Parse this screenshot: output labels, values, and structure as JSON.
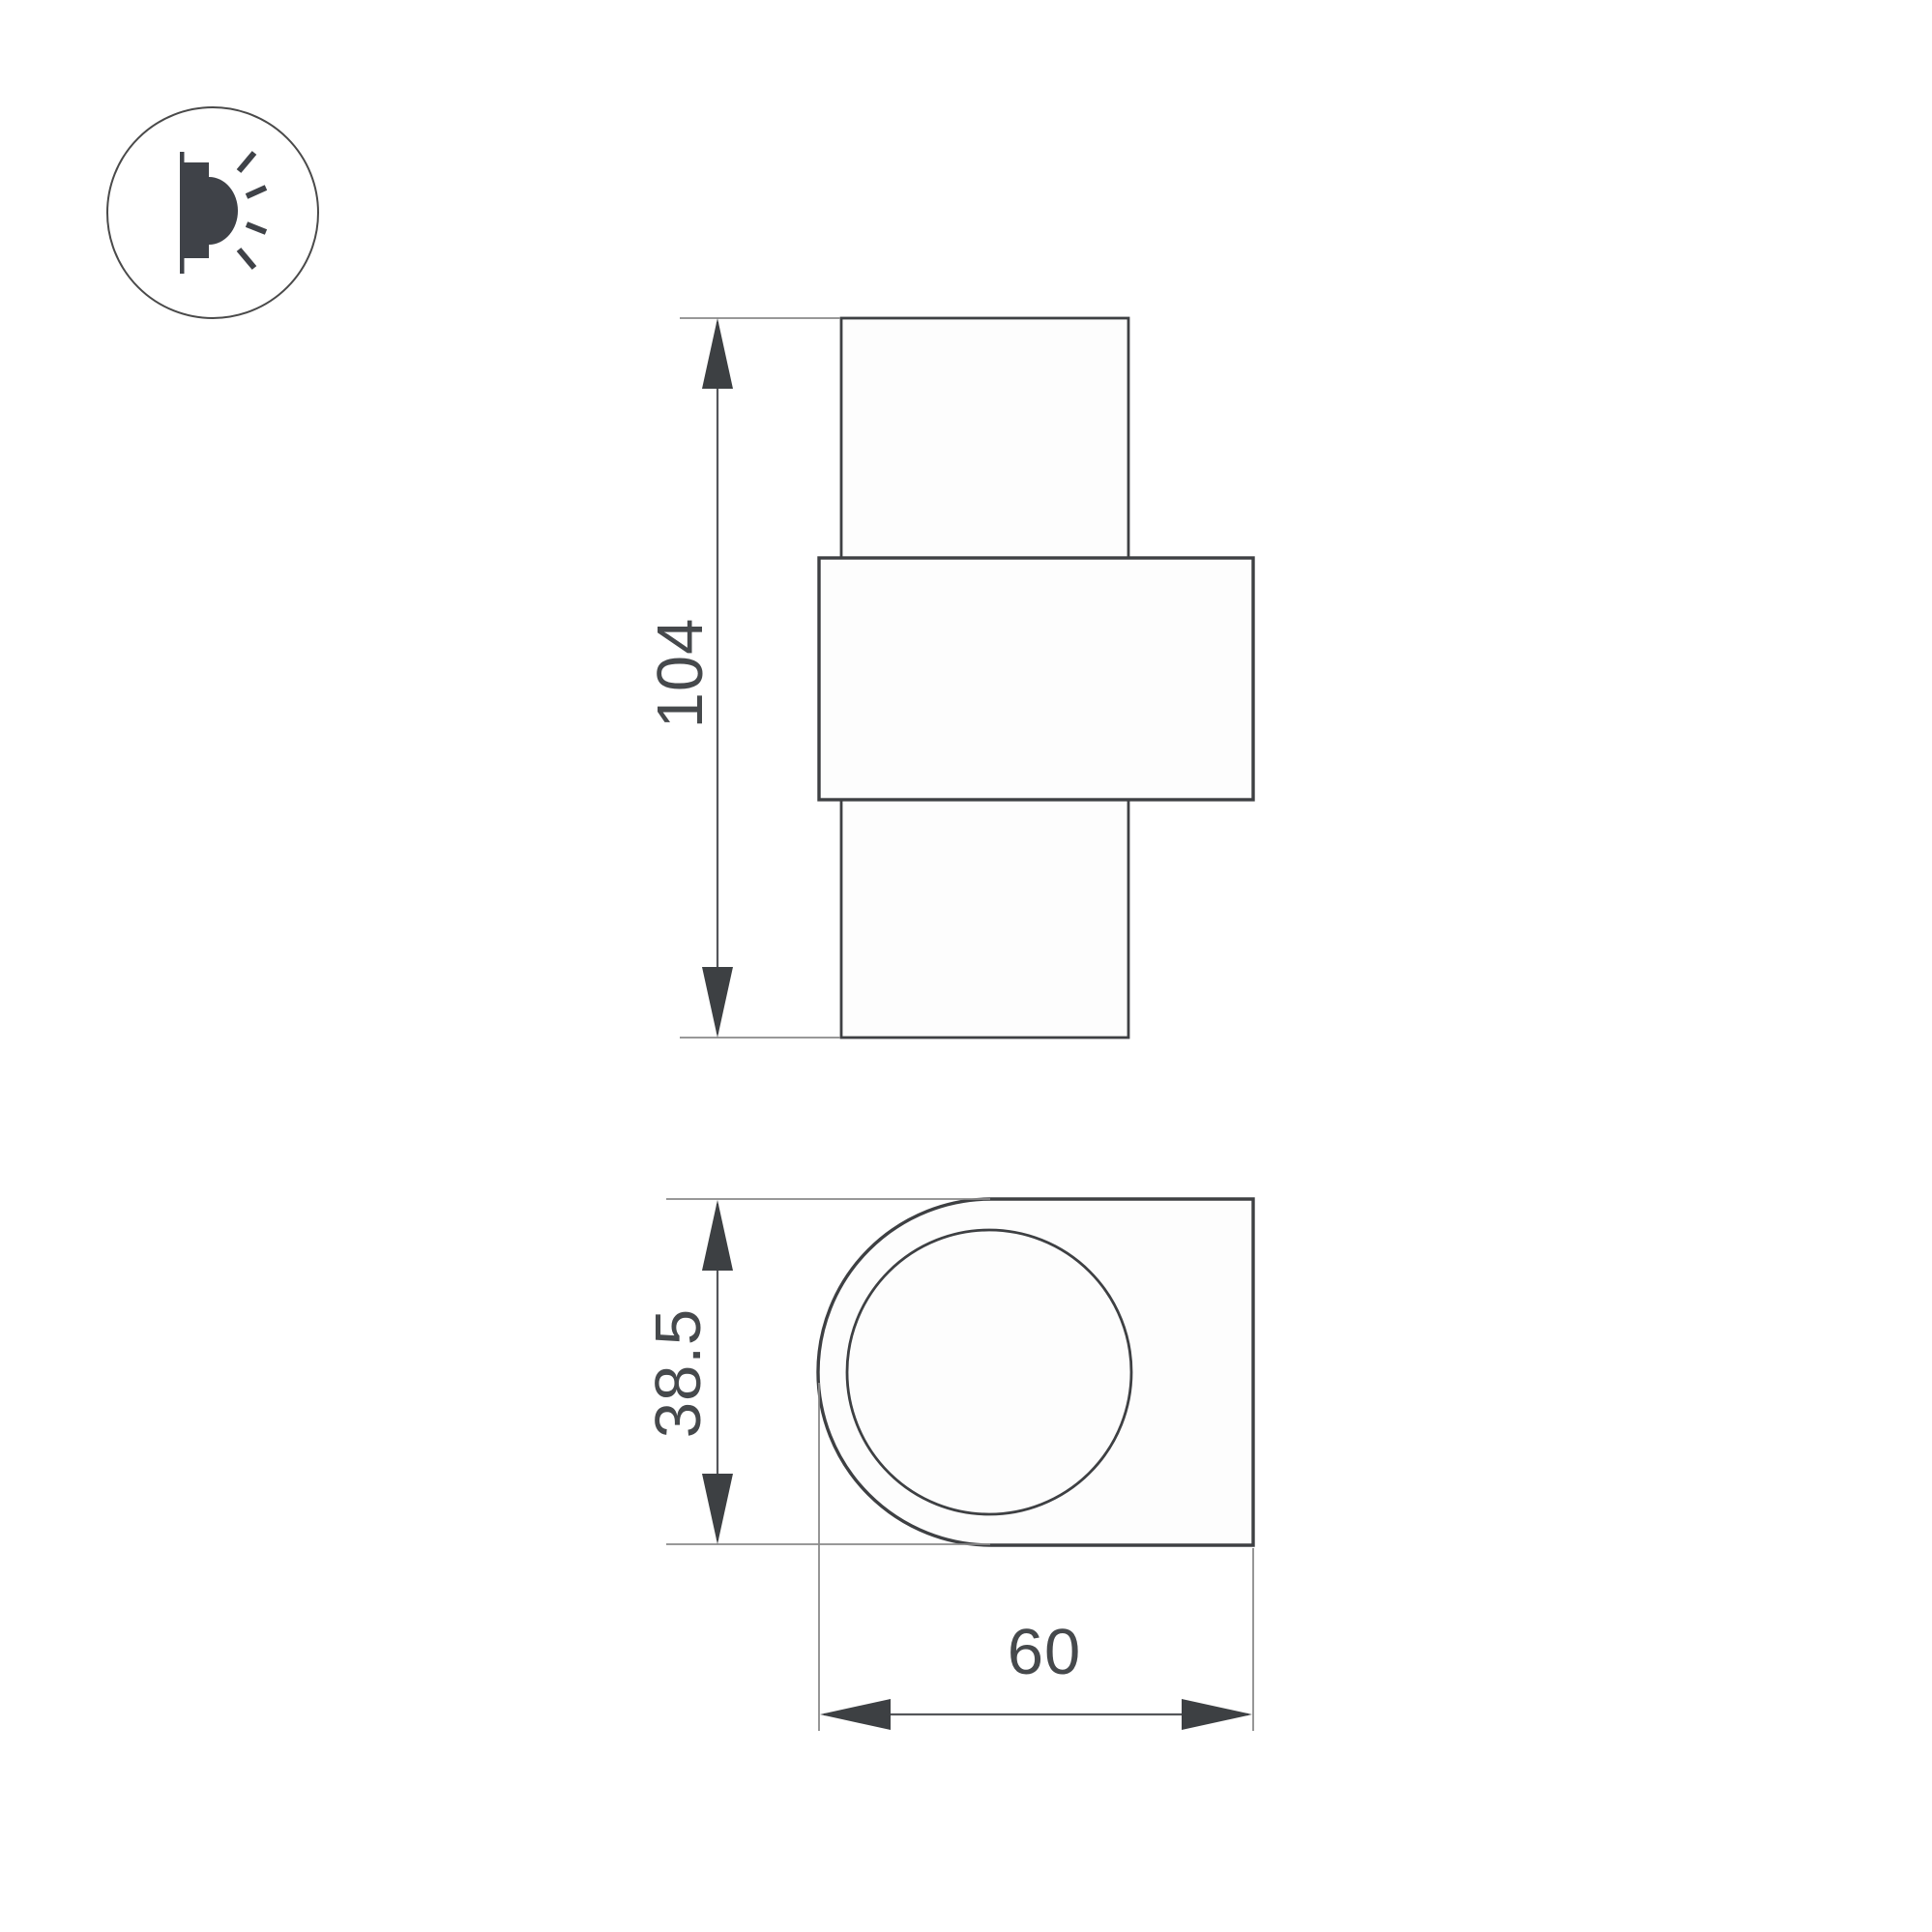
{
  "page": {
    "background": "#ffffff",
    "description_labels": []
  },
  "icon": {
    "name": "wall-lamp-icon",
    "meaning": "wall-mounted luminaire emitting light sideways"
  },
  "drawing": {
    "front_view": {
      "height_label": "104"
    },
    "side_view": {
      "depth_label": "38.5",
      "width_label": "60"
    }
  },
  "colors": {
    "outline": "#3e4043",
    "dimension_line": "#54565a",
    "extension_line": "#8a8a8a",
    "arrow_fill": "#3d4043",
    "text": "#46494c",
    "background": "#ffffff"
  }
}
